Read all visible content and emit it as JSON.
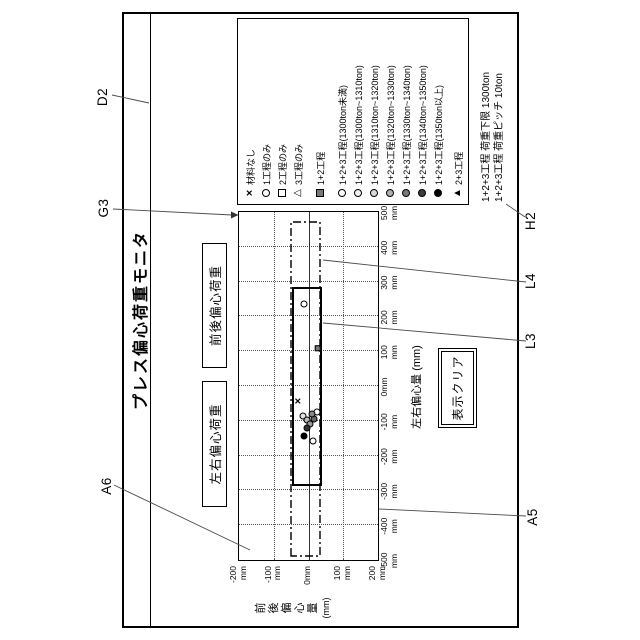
{
  "window": {
    "title": "プレス偏心荷重モニタ"
  },
  "buttons": {
    "left_right": "左右偏心荷重",
    "front_back": "前後偏心荷重",
    "clear": "表示クリア"
  },
  "legend": {
    "items": [
      {
        "marker": "x",
        "label": "材料なし"
      },
      {
        "marker": "circle",
        "fill": "#ffffff",
        "label": "1工程のみ"
      },
      {
        "marker": "square",
        "fill": "none",
        "label": "2工程のみ"
      },
      {
        "marker": "triangle-open",
        "label": "3工程のみ"
      },
      {
        "marker": "square",
        "fill": "#777777",
        "label": "1+2工程",
        "group_gap": 6
      },
      {
        "marker": "circle",
        "fill": "#ffffff",
        "label": "1+2+3工程(1300ton未満)",
        "group_gap": 6
      },
      {
        "marker": "circle",
        "fill": "#f2f2f2",
        "label": "1+2+3工程(1300ton~1310ton)"
      },
      {
        "marker": "circle",
        "fill": "#d8d8d8",
        "label": "1+2+3工程(1310ton~1320ton)"
      },
      {
        "marker": "circle",
        "fill": "#b0b0b0",
        "label": "1+2+3工程(1320ton~1330ton)"
      },
      {
        "marker": "circle",
        "fill": "#7a7a7a",
        "label": "1+2+3工程(1330ton~1340ton)"
      },
      {
        "marker": "circle",
        "fill": "#3c3c3c",
        "label": "1+2+3工程(1340ton~1350ton)"
      },
      {
        "marker": "circle",
        "fill": "#000000",
        "label": "1+2+3工程(1350ton以上)"
      },
      {
        "marker": "triangle-filled",
        "label": "2+3工程",
        "group_gap": 4
      }
    ]
  },
  "annotation": {
    "lines": [
      "1+2+3工程 荷重下限 1300ton",
      "1+2+3工程 荷重ピッチ  10ton"
    ]
  },
  "axes": {
    "x": {
      "title": "左右偏心量 (mm)",
      "unit": "mm",
      "ticks": [
        -500,
        -400,
        -300,
        -200,
        -100,
        0,
        100,
        200,
        300,
        400,
        500
      ],
      "range": [
        -500,
        500
      ]
    },
    "y": {
      "title": "前後偏心量",
      "unit": "(mm)",
      "ticks": [
        -200,
        -100,
        0,
        100,
        200
      ],
      "range": [
        -200,
        200
      ]
    }
  },
  "ref_labels": {
    "d2": "D2",
    "g3": "G3",
    "a6": "A6",
    "h2": "H2",
    "l4": "L4",
    "l3": "L3",
    "a5": "A5"
  },
  "chart_data": {
    "type": "scatter",
    "title": "プレス偏心荷重モニタ",
    "xlabel": "左右偏心量 (mm)",
    "ylabel": "前後偏心量 (mm)",
    "xlim": [
      -500,
      500
    ],
    "ylim": [
      -200,
      200
    ],
    "y_axis_direction": "negative-up",
    "grid": true,
    "grid_step_mm": 100,
    "regions": [
      {
        "name": "load-range-outline",
        "style": "dash-dot",
        "x": [
          -486,
          474
        ],
        "y": [
          -48,
          36
        ]
      },
      {
        "name": "die-area",
        "style": "solid",
        "x": [
          -282,
          285
        ],
        "y": [
          -42,
          38
        ]
      }
    ],
    "points": [
      {
        "marker": "circle-open",
        "x": 235,
        "y": -13
      },
      {
        "marker": "square-filled",
        "x": 109,
        "y": 27,
        "fill": "#777777"
      },
      {
        "marker": "x",
        "x": -43,
        "y": -27
      },
      {
        "marker": "circle-open",
        "x": -75,
        "y": 24
      },
      {
        "marker": "circle-shaded",
        "x": -86,
        "y": -16,
        "fill": "#e0e0e0"
      },
      {
        "marker": "circle-shaded",
        "x": -98,
        "y": -4,
        "fill": "#bbbbbb"
      },
      {
        "marker": "circle-shaded",
        "x": -109,
        "y": 4,
        "fill": "#999999"
      },
      {
        "marker": "circle-shaded",
        "x": -95,
        "y": 16,
        "fill": "#666666"
      },
      {
        "marker": "circle-shaded",
        "x": -80,
        "y": 10,
        "fill": "#888888"
      },
      {
        "marker": "circle-shaded",
        "x": -121,
        "y": -4,
        "fill": "#333333"
      },
      {
        "marker": "circle-filled",
        "x": -144,
        "y": -13,
        "fill": "#000000"
      },
      {
        "marker": "circle-open",
        "x": -158,
        "y": 13
      }
    ]
  }
}
